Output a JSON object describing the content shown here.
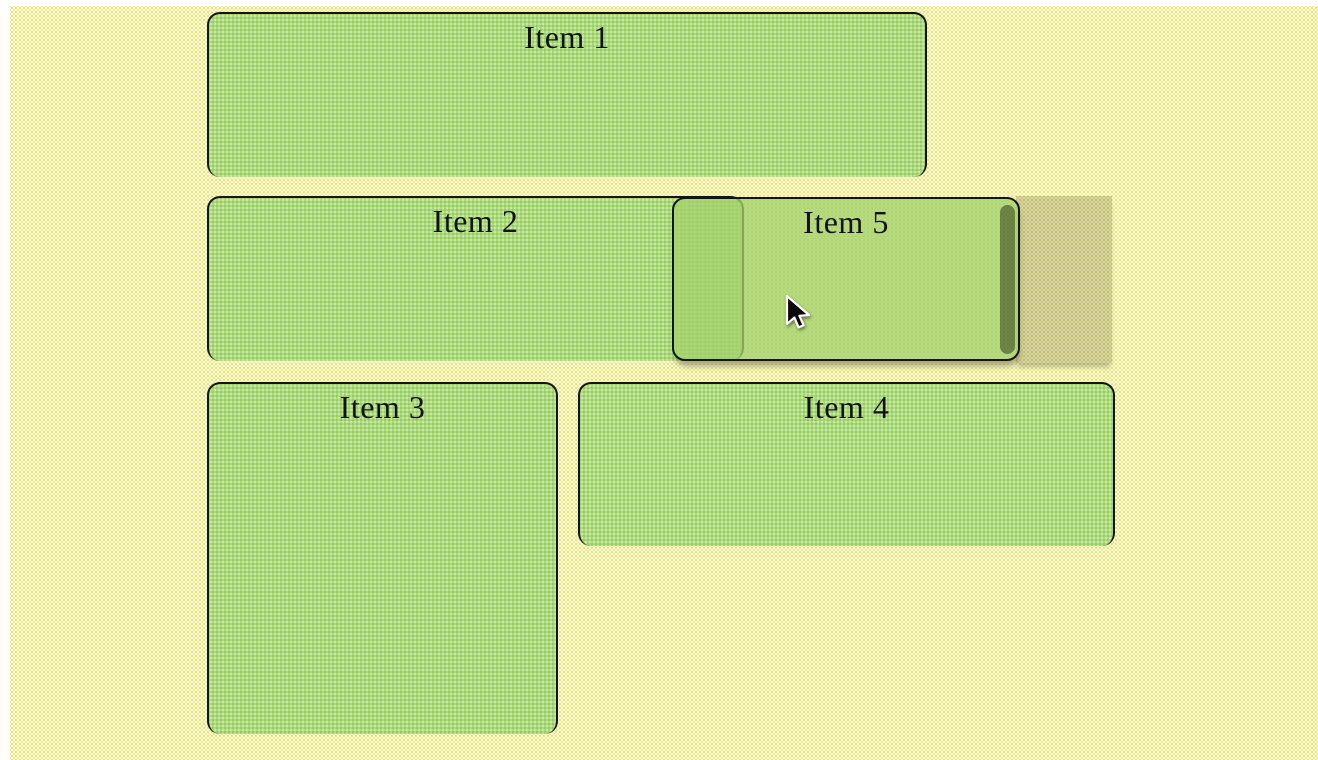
{
  "items": [
    {
      "id": "item-1",
      "label": "Item 1"
    },
    {
      "id": "item-2",
      "label": "Item 2"
    },
    {
      "id": "item-3",
      "label": "Item 3"
    },
    {
      "id": "item-4",
      "label": "Item 4"
    }
  ],
  "drag_item": {
    "label": "Item 5"
  },
  "colors": {
    "canvas_tint": "#eff0c3",
    "item_fill": "#abd97d",
    "item_border": "#141414",
    "drag_fill": "rgba(163,209,106,0.78)",
    "ghost_fill": "#d7d3a8",
    "scrollbar_thumb": "#6e7b50",
    "label_text": "#111111"
  },
  "cursor": {
    "type": "arrow"
  }
}
